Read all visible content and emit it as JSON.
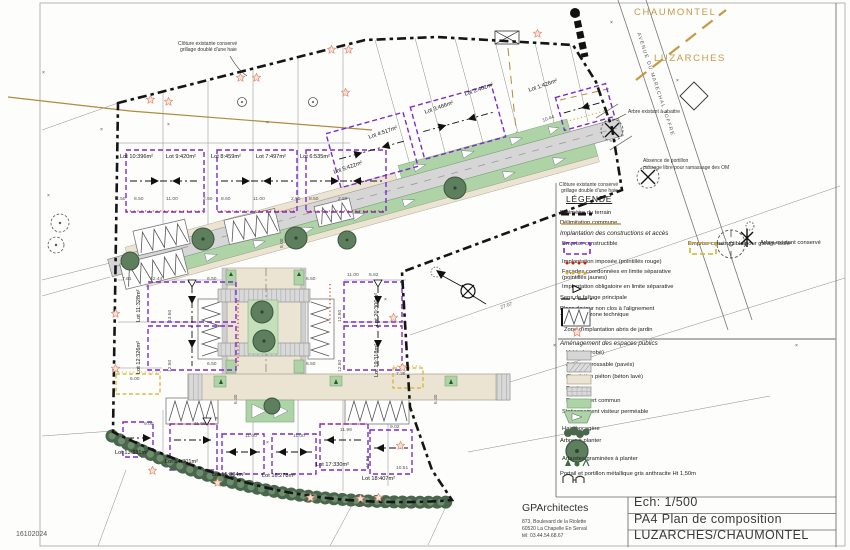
{
  "title_block": {
    "architect": "GPArchitectes",
    "address1": "873, Boulevard de la Riolette",
    "address2": "60520 La Chapelle En Serval",
    "phone": "tél: 03.44.54.68.67",
    "scale": "Ech:  1/500",
    "sheet": "PA4 Plan de composition",
    "project": "LUZARCHES/CHAUMONTEL"
  },
  "drawing": {
    "date_stamp": "16102024",
    "x_mark": "×",
    "communes": {
      "north": "CHAUMONTEL",
      "south": "LUZARCHES"
    },
    "street": "AVENUE DU MARECHAL JOFFRE",
    "notes": {
      "fence_top_1": "Clôture existante conservé",
      "fence_top_2": "grillage doublé d'une haie",
      "fence_right_1": "Clôture existante conservé",
      "fence_right_2": "grillage double d'une haie",
      "tree_fell": "Arbre existant à abattre",
      "gate_1": "Absence de portillon",
      "gate_2": "passage libre pour ramassage des OM"
    },
    "lots": [
      "Lot 1:426m²",
      "Lot 2:402m²",
      "Lot 3:466m²",
      "Lot 4:517m²",
      "Lot 5:422m²",
      "Lot 6:535m²",
      "Lot 7:497m²",
      "Lot 8:459m²",
      "Lot 9:420m²",
      "Lot 10:396m²",
      "Lot 11:328m²",
      "Lot 12:326m²",
      "Lot 13:331m²",
      "Lot 14:301m²",
      "Lot 15:304m²",
      "Lot 16:278m²",
      "Lot 17:330m²",
      "Lot 18:407m²",
      "Lot 19:318m²",
      "Lot 20:300m²"
    ],
    "dims": [
      "2.50",
      "8.50",
      "11.00",
      "2.50",
      "8.50",
      "11.00",
      "2.50",
      "8.50",
      "2.50",
      "7.61",
      "12.44",
      "6.50",
      "6.50",
      "13.50",
      "12.50",
      "12.50",
      "12.50",
      "6.50",
      "6.50",
      "6.00",
      "11.00",
      "5.82",
      "9.00",
      "11.50",
      "11.00",
      "11.00",
      "11.99",
      "9.02",
      "10.51",
      "12.93",
      "7.36",
      "6.30",
      "6.30",
      "27.07",
      "10.44",
      "5.00"
    ]
  },
  "legend": {
    "title": "LÉGENDE",
    "perimeter": "Périmètre du terrain",
    "commune": "Délimitation commune",
    "section_implantation": "Implantation des constructions et accès",
    "emprise": "Emprise constructible",
    "emprise_garage": "Emprise constructible pour garage isolé",
    "imposee": "Implantation imposée (pointillés rouge)",
    "facades_1": "Façades coordonnées en limite séparative",
    "facades_2": "(pointillés jaunes)",
    "obligatoire": "Implantation obligatoire en limite séparative",
    "faitage": "Sens de faîtage principale",
    "place_1": "Place de jour non clos à l'alignement",
    "place_2": "+ muret ou zone technique",
    "abris": "Zone d'implantation abris de jardin",
    "arbre_conserve": "Arbre existant conservé",
    "section_amenagement": "Aménagement des espaces publics",
    "voirie": "Voirie (enrobé)",
    "acces": "Accès carrossable (pavés)",
    "pieton": "Circulation piéton (béton lavé)",
    "paves": "Pavés",
    "espace_vert": "Espace vert commun",
    "stationnement": "Stationnement visiteur perméable",
    "haie": "Haie bocagère",
    "arbres": "Arbres à planter",
    "arbustes": "Arbustes/graminées à planter",
    "portail": "Portail et portillon métallique gris anthracite Ht 1,50m"
  },
  "colors": {
    "emprise": "#7d2bc9",
    "garage": "#d4b02c",
    "commune": "#c49a44",
    "star": "#d98a72",
    "espace_vert": "#aed3a6",
    "voirie": "#d6d6d6",
    "beton": "#ece4d2",
    "arbre": "#5d7f5e",
    "impose_rouge": "#cc2200"
  }
}
